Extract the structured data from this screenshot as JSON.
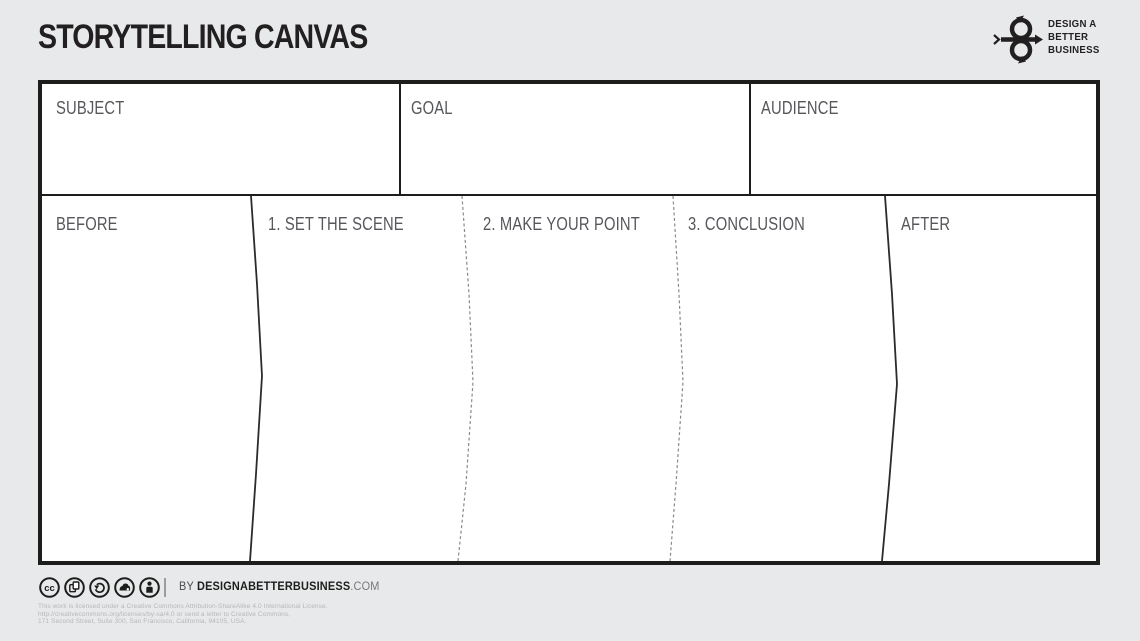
{
  "header": {
    "title": "STORYTELLING CANVAS",
    "logo": {
      "line1": "DESIGN A",
      "line2": "BETTER",
      "line3": "BUSINESS"
    }
  },
  "canvas": {
    "top_row": [
      {
        "label": "SUBJECT"
      },
      {
        "label": "GOAL"
      },
      {
        "label": "AUDIENCE"
      }
    ],
    "main_row": [
      {
        "label": "BEFORE"
      },
      {
        "label": "1. SET THE SCENE"
      },
      {
        "label": "2. MAKE YOUR POINT"
      },
      {
        "label": "3. CONCLUSION"
      },
      {
        "label": "AFTER"
      }
    ]
  },
  "footer": {
    "icons": [
      "cc-icon",
      "copy-icon",
      "share-alike-icon",
      "remix-icon",
      "attribution-icon"
    ],
    "byline_prefix": "BY ",
    "byline_bold": "DESIGNABETTERBUSINESS",
    "byline_suffix": ".COM",
    "license_lines": [
      "This work is licensed under a Creative Commons Attribution-ShareAlike 4.0 International License.",
      "http://creativecommons.org/licenses/by-sa/4.0 or send a letter to Creative Commons,",
      "171 Second Street, Suite 300, San Francisco, California, 94105, USA."
    ]
  },
  "colors": {
    "background": "#e8e9eb",
    "canvas_background": "#ffffff",
    "border": "#1d1d1b",
    "label_text": "#56575b",
    "dashed_line": "#8a8a8a",
    "license_text": "#b4b7b9"
  }
}
